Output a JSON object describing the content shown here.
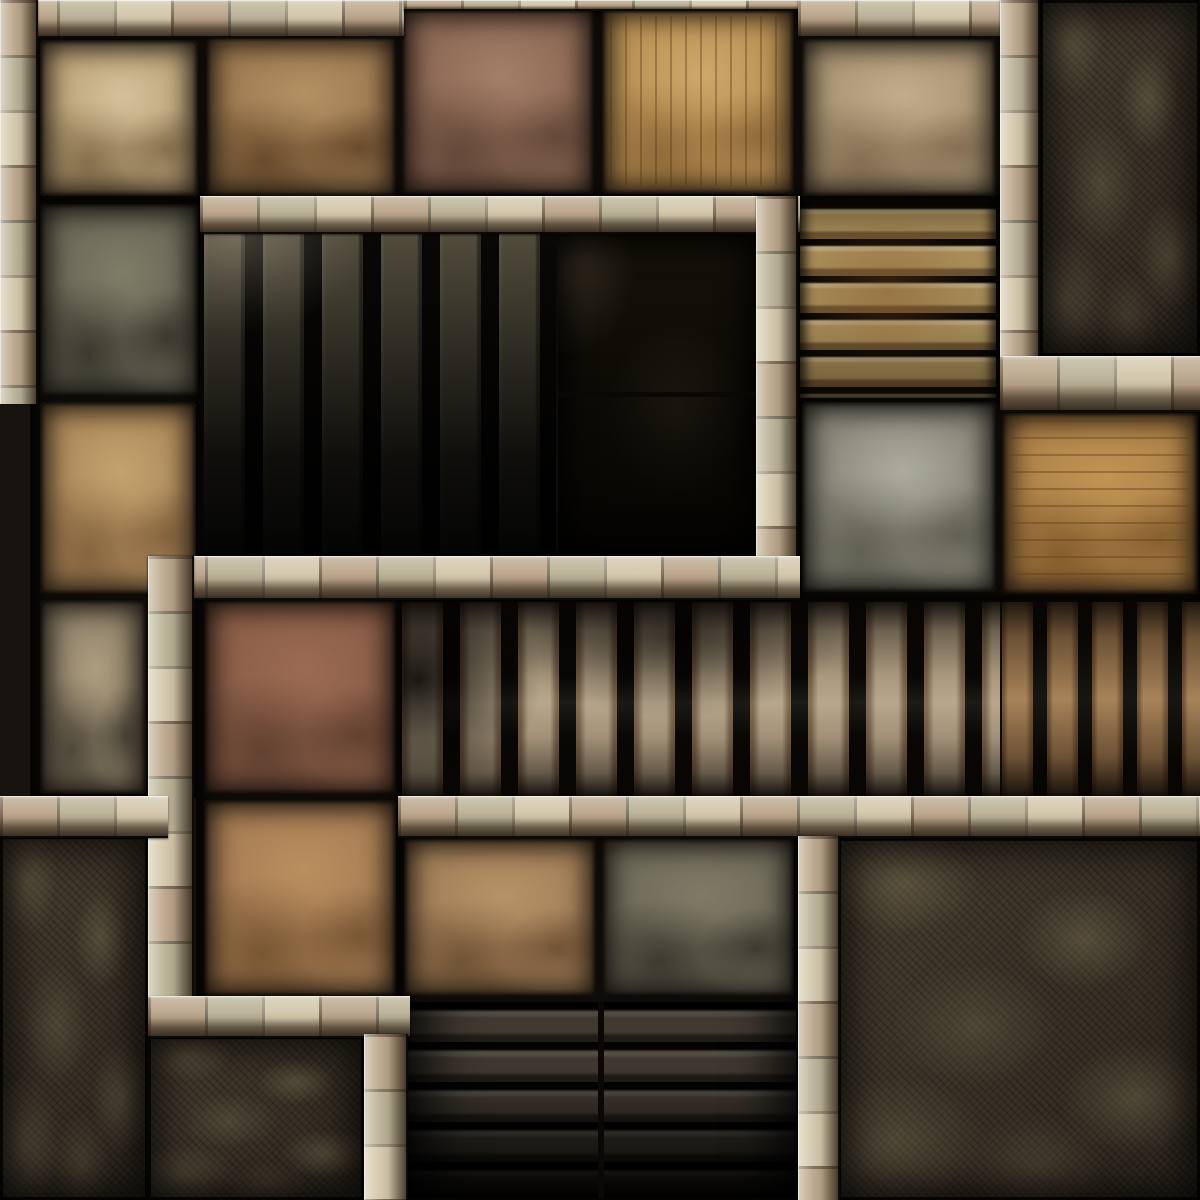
{
  "map": {
    "scene": "dungeon-floor-map-tile",
    "width": 1200,
    "height": 1200,
    "palette": {
      "background": "#17130e",
      "seam": "#0d0a07",
      "wall_light": "#d8cdb4",
      "wall_base": "#c5b697",
      "wall_bevel_dark": "#2a1d10",
      "rock": "#3a3327",
      "pit": "#151109",
      "stair_slat": "#b2a084"
    },
    "legend": {
      "tile": "stone floor tile",
      "wall-h": "horizontal wall of beige bricks",
      "wall-v": "vertical wall of beige bricks",
      "stairs-v": "staircase of vertical stone slats",
      "stairs-h": "descending stone steps",
      "pit": "dark pit floor",
      "rock": "unexcavated dark rock",
      "backing": "dark floor seams behind tiles",
      "seam": "dark joint line",
      "overlay": "shadow overlay"
    },
    "regions": [
      {
        "name": "backing-top-rooms",
        "type": "backing",
        "rect": [
          30,
          4,
          1008,
          198
        ]
      },
      {
        "name": "backing-left-column",
        "type": "backing",
        "rect": [
          30,
          198,
          172,
          600
        ]
      },
      {
        "name": "backing-pit-room",
        "type": "backing",
        "rect": [
          196,
          230,
          564,
          330
        ]
      },
      {
        "name": "backing-steps-topright",
        "type": "backing",
        "rect": [
          796,
          196,
          206,
          208
        ]
      },
      {
        "name": "backing-row3-right",
        "type": "backing",
        "rect": [
          796,
          396,
          404,
          208
        ]
      },
      {
        "name": "backing-corridor",
        "type": "backing",
        "rect": [
          396,
          596,
          804,
          204
        ]
      },
      {
        "name": "backing-brown-corridor",
        "type": "backing",
        "rect": [
          196,
          556,
          206,
          446
        ]
      },
      {
        "name": "backing-bottom-room",
        "type": "backing",
        "rect": [
          398,
          830,
          402,
          370
        ]
      },
      {
        "name": "floor-tile-cream",
        "type": "tile",
        "rect": [
          40,
          40,
          158,
          156
        ],
        "colors": {
          "base": "#bfa67c",
          "hi": "rgba(225,210,175,0.6)",
          "lo": "rgba(90,70,40,0.55)"
        }
      },
      {
        "name": "floor-tile-brown-veined",
        "type": "tile",
        "rect": [
          206,
          36,
          190,
          160
        ],
        "colors": {
          "base": "#9f7b52",
          "hi": "rgba(200,165,115,0.5)",
          "lo": "rgba(70,45,20,0.6)"
        }
      },
      {
        "name": "floor-tile-mauve",
        "type": "tile",
        "rect": [
          402,
          8,
          192,
          186
        ],
        "colors": {
          "base": "#8d6a55",
          "hi": "rgba(190,150,125,0.45)",
          "lo": "rgba(75,50,38,0.6)"
        }
      },
      {
        "name": "floor-tile-gold-striated",
        "type": "tile",
        "rect": [
          602,
          8,
          192,
          186
        ],
        "variant": "striate-v",
        "colors": {
          "base": "#ba9256",
          "hi": "rgba(225,190,125,0.5)",
          "lo": "rgba(105,70,30,0.5)"
        }
      },
      {
        "name": "floor-tile-pale-tan",
        "type": "tile",
        "rect": [
          802,
          38,
          194,
          158
        ],
        "colors": {
          "base": "#ab9675",
          "hi": "rgba(210,195,160,0.5)",
          "lo": "rgba(100,80,55,0.55)"
        }
      },
      {
        "name": "floor-tile-slate",
        "type": "tile",
        "rect": [
          40,
          204,
          158,
          192
        ],
        "colors": {
          "base": "#6c6a59",
          "hi": "rgba(150,148,120,0.45)",
          "lo": "rgba(40,38,28,0.7)"
        }
      },
      {
        "name": "floor-tile-tan-rough",
        "type": "tile",
        "rect": [
          40,
          402,
          156,
          192
        ],
        "colors": {
          "base": "#b08b5c",
          "hi": "rgba(215,185,130,0.5)",
          "lo": "rgba(100,70,40,0.55)"
        }
      },
      {
        "name": "floor-tile-gray-veined",
        "type": "tile",
        "rect": [
          802,
          402,
          194,
          190
        ],
        "colors": {
          "base": "#8b897a",
          "hi": "rgba(200,200,185,0.55)",
          "lo": "rgba(70,70,58,0.6)"
        }
      },
      {
        "name": "floor-tile-amber-striated",
        "type": "tile",
        "rect": [
          1002,
          412,
          196,
          182
        ],
        "variant": "striate-h",
        "colors": {
          "base": "#b08349",
          "hi": "rgba(210,165,95,0.5)",
          "lo": "rgba(100,65,25,0.55)"
        }
      },
      {
        "name": "floor-tile-graytan",
        "type": "tile",
        "rect": [
          40,
          600,
          106,
          194
        ],
        "colors": {
          "base": "#8d8068",
          "hi": "rgba(200,180,145,0.55)",
          "lo": "rgba(55,50,40,0.7)"
        }
      },
      {
        "name": "floor-tile-redbrown",
        "type": "tile",
        "rect": [
          204,
          600,
          192,
          194
        ],
        "colors": {
          "base": "#8c5f49",
          "hi": "rgba(175,120,95,0.45)",
          "lo": "rgba(70,45,32,0.6)"
        }
      },
      {
        "name": "floor-tile-brown-carved",
        "type": "tile",
        "rect": [
          204,
          800,
          192,
          196
        ],
        "colors": {
          "base": "#a87e55",
          "hi": "rgba(205,160,105,0.5)",
          "lo": "rgba(90,60,30,0.6)"
        }
      },
      {
        "name": "floor-tile-tan-south",
        "type": "tile",
        "rect": [
          404,
          838,
          192,
          158
        ],
        "colors": {
          "base": "#a4805a",
          "hi": "rgba(200,165,115,0.5)",
          "lo": "rgba(80,55,30,0.6)"
        }
      },
      {
        "name": "floor-tile-gray-south",
        "type": "tile",
        "rect": [
          602,
          838,
          192,
          158
        ],
        "colors": {
          "base": "#706c5b",
          "hi": "rgba(145,140,115,0.45)",
          "lo": "rgba(40,38,30,0.7)"
        }
      },
      {
        "name": "pit-room-slat-stairs",
        "type": "stairs-v",
        "rect": [
          204,
          234,
          352,
          320
        ],
        "variant": "pit",
        "colors": {
          "base": "#55503f"
        }
      },
      {
        "name": "pit-floor",
        "type": "pit",
        "rect": [
          558,
          234,
          198,
          320
        ]
      },
      {
        "name": "pit-tile-seam",
        "type": "seam",
        "rect": [
          558,
          392,
          198,
          5
        ]
      },
      {
        "name": "steps-topright",
        "type": "stairs-h",
        "rect": [
          800,
          202,
          196,
          196
        ],
        "variant": "tr",
        "colors": {
          "base": "#b1955f"
        }
      },
      {
        "name": "corridor-slat-stairs",
        "type": "stairs-v",
        "rect": [
          402,
          602,
          598,
          194
        ],
        "variant": "main",
        "colors": {
          "base": "#b2a084"
        }
      },
      {
        "name": "corridor-slat-stairs-right",
        "type": "stairs-v",
        "rect": [
          1002,
          602,
          198,
          194
        ],
        "variant": "right",
        "colors": {
          "base": "#a27b50"
        }
      },
      {
        "name": "steps-bottom-descending",
        "type": "stairs-h",
        "rect": [
          402,
          1002,
          394,
          196
        ],
        "variant": "bottom",
        "colors": {
          "base": "#6d6253"
        }
      },
      {
        "name": "steps-bottom-center-seam",
        "type": "seam",
        "rect": [
          598,
          1002,
          6,
          196
        ]
      },
      {
        "name": "rock-top-right",
        "type": "rock",
        "rect": [
          1040,
          0,
          160,
          356
        ]
      },
      {
        "name": "rock-bottom-left",
        "type": "rock",
        "rect": [
          0,
          836,
          148,
          364
        ]
      },
      {
        "name": "rock-bottom-left-east",
        "type": "rock",
        "rect": [
          148,
          1036,
          216,
          164
        ]
      },
      {
        "name": "rock-bottom-right",
        "type": "rock",
        "rect": [
          838,
          838,
          362,
          362
        ]
      },
      {
        "name": "corridor-shadow-overlay",
        "type": "overlay",
        "rect": [
          402,
          602,
          798,
          194
        ],
        "variant": "corridor-shade"
      },
      {
        "name": "wall-top-west",
        "type": "wall-h",
        "rect": [
          0,
          0,
          404,
          38
        ]
      },
      {
        "name": "wall-top-center-thin",
        "type": "wall-h",
        "rect": [
          404,
          0,
          394,
          11
        ]
      },
      {
        "name": "wall-top-east",
        "type": "wall-h",
        "rect": [
          798,
          0,
          242,
          38
        ]
      },
      {
        "name": "wall-left-outer",
        "type": "wall-v",
        "rect": [
          0,
          0,
          38,
          404
        ]
      },
      {
        "name": "wall-pit-room-top",
        "type": "wall-h",
        "rect": [
          200,
          196,
          600,
          38
        ]
      },
      {
        "name": "wall-pit-room-right",
        "type": "wall-v",
        "rect": [
          756,
          196,
          42,
          404
        ]
      },
      {
        "name": "wall-pit-room-bottom",
        "type": "wall-h",
        "rect": [
          148,
          556,
          652,
          44
        ]
      },
      {
        "name": "wall-mid-vertical",
        "type": "wall-v",
        "rect": [
          148,
          556,
          46,
          448
        ]
      },
      {
        "name": "wall-west-stub",
        "type": "wall-h",
        "rect": [
          0,
          796,
          168,
          42
        ]
      },
      {
        "name": "wall-south-long",
        "type": "wall-h",
        "rect": [
          398,
          796,
          802,
          42
        ]
      },
      {
        "name": "wall-bottomleft-horizontal",
        "type": "wall-h",
        "rect": [
          148,
          996,
          262,
          42
        ]
      },
      {
        "name": "wall-bottomleft-vertical",
        "type": "wall-v",
        "rect": [
          364,
          1034,
          44,
          166
        ]
      },
      {
        "name": "wall-bottomright-vertical",
        "type": "wall-v",
        "rect": [
          798,
          836,
          42,
          364
        ]
      },
      {
        "name": "wall-topright-vertical",
        "type": "wall-v",
        "rect": [
          1000,
          0,
          40,
          360
        ]
      },
      {
        "name": "wall-topright-horizontal",
        "type": "wall-h",
        "rect": [
          1000,
          356,
          200,
          56
        ]
      }
    ]
  }
}
